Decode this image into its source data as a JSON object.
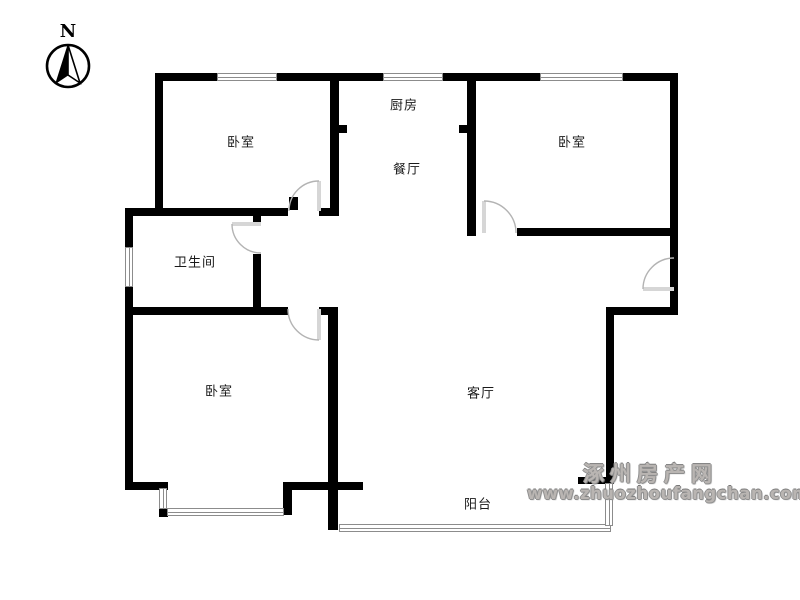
{
  "compass": {
    "label": "N"
  },
  "rooms": [
    {
      "id": "bedroom-top-left",
      "label": "卧室"
    },
    {
      "id": "kitchen",
      "label": "厨房"
    },
    {
      "id": "dining-room",
      "label": "餐厅"
    },
    {
      "id": "bedroom-top-right",
      "label": "卧室"
    },
    {
      "id": "bathroom",
      "label": "卫生间"
    },
    {
      "id": "bedroom-bottom-left",
      "label": "卧室"
    },
    {
      "id": "living-room",
      "label": "客厅"
    },
    {
      "id": "balcony",
      "label": "阳台"
    }
  ],
  "watermark": {
    "site_name": "涿州房产网",
    "site_url": "www.zhuozhoufangchan.com"
  },
  "colors": {
    "wall": "#000000",
    "window_line": "#8c8c8c",
    "door_arc": "#b3b3b3",
    "door_leaf": "#d6d6d6",
    "label_text": "#1a1a1a",
    "watermark_text": "#9a9a9a",
    "background": "#ffffff"
  },
  "floorplan": {
    "walls": [
      {
        "id": "top-wall",
        "x": 155,
        "y": 73,
        "w": 523,
        "h": 8
      },
      {
        "id": "left-wall-upper",
        "x": 155,
        "y": 73,
        "w": 8,
        "h": 143
      },
      {
        "id": "bathroom-top-wall",
        "x": 125,
        "y": 208,
        "w": 163,
        "h": 8
      },
      {
        "id": "left-wall-lower",
        "x": 125,
        "y": 208,
        "w": 8,
        "h": 282
      },
      {
        "id": "bedroom1-kitchen-wall",
        "x": 330,
        "y": 73,
        "w": 9,
        "h": 143
      },
      {
        "id": "kitchen-stub-left",
        "x": 339,
        "y": 125,
        "w": 8,
        "h": 8
      },
      {
        "id": "bedroom1-corner-piece",
        "x": 319,
        "y": 208,
        "w": 11,
        "h": 8
      },
      {
        "id": "kitchen-dining-right-wall",
        "x": 467,
        "y": 73,
        "w": 9,
        "h": 163
      },
      {
        "id": "dining-stub-right",
        "x": 459,
        "y": 125,
        "w": 8,
        "h": 8
      },
      {
        "id": "bedroom2-bottom-wall",
        "x": 517,
        "y": 228,
        "w": 161,
        "h": 8
      },
      {
        "id": "right-wall-upper",
        "x": 670,
        "y": 73,
        "w": 8,
        "h": 241
      },
      {
        "id": "right-step-wall",
        "x": 606,
        "y": 307,
        "w": 72,
        "h": 8
      },
      {
        "id": "right-wall-lower",
        "x": 606,
        "y": 313,
        "w": 8,
        "h": 170
      },
      {
        "id": "living-bottom-right-stub",
        "x": 578,
        "y": 477,
        "w": 36,
        "h": 7
      },
      {
        "id": "bathroom-right-stub",
        "x": 253,
        "y": 208,
        "w": 8,
        "h": 14
      },
      {
        "id": "bathroom-right-wall",
        "x": 253,
        "y": 254,
        "w": 8,
        "h": 61
      },
      {
        "id": "bathroom-bottom-wall",
        "x": 125,
        "y": 307,
        "w": 163,
        "h": 8
      },
      {
        "id": "bedroom3-corner-piece",
        "x": 319,
        "y": 307,
        "w": 19,
        "h": 8
      },
      {
        "id": "bedroom3-right-wall",
        "x": 328,
        "y": 307,
        "w": 10,
        "h": 223
      },
      {
        "id": "bedroom3-bottom-left",
        "x": 125,
        "y": 482,
        "w": 43,
        "h": 8
      },
      {
        "id": "bedroom3-bottom-right",
        "x": 283,
        "y": 482,
        "w": 80,
        "h": 8
      },
      {
        "id": "bay-right-post",
        "x": 283,
        "y": 488,
        "w": 9,
        "h": 27
      },
      {
        "id": "bay-left-foot",
        "x": 159,
        "y": 508,
        "w": 9,
        "h": 9
      },
      {
        "id": "hall-door-jamb-post",
        "x": 289,
        "y": 197,
        "w": 9,
        "h": 13
      }
    ],
    "windows": [
      {
        "id": "bedroom1-window",
        "x": 217,
        "y": 73,
        "w": 60,
        "h": 8
      },
      {
        "id": "kitchen-window",
        "x": 383,
        "y": 73,
        "w": 60,
        "h": 8
      },
      {
        "id": "bedroom2-window",
        "x": 540,
        "y": 73,
        "w": 83,
        "h": 8
      },
      {
        "id": "bathroom-window",
        "x": 125,
        "y": 247,
        "w": 8,
        "h": 40
      },
      {
        "id": "bay-window-left",
        "x": 159,
        "y": 488,
        "w": 8,
        "h": 21
      },
      {
        "id": "bay-window-bottom",
        "x": 167,
        "y": 508,
        "w": 117,
        "h": 8
      },
      {
        "id": "balcony-window-bottom",
        "x": 339,
        "y": 524,
        "w": 272,
        "h": 8
      },
      {
        "id": "balcony-window-right",
        "x": 605,
        "y": 483,
        "w": 8,
        "h": 43
      }
    ],
    "doors": [
      {
        "id": "bedroom1-door",
        "arc": "M289,211 A30,30 0 0 1 319,181",
        "leaf": "M319,211 L319,181"
      },
      {
        "id": "bedroom2-door",
        "arc": "M484,201 A32,32 0 0 1 516,233",
        "leaf": "M484,233 L484,201"
      },
      {
        "id": "bathroom-door",
        "arc": "M232,224 A29,29 0 0 0 261,253",
        "leaf": "M261,224 L232,224"
      },
      {
        "id": "bedroom3-door",
        "arc": "M288,309 A31,31 0 0 0 319,340",
        "leaf": "M319,309 L319,340"
      },
      {
        "id": "entrance-door",
        "arc": "M643,289 A31,31 0 0 1 674,258",
        "leaf": "M674,289 L643,289"
      }
    ]
  }
}
